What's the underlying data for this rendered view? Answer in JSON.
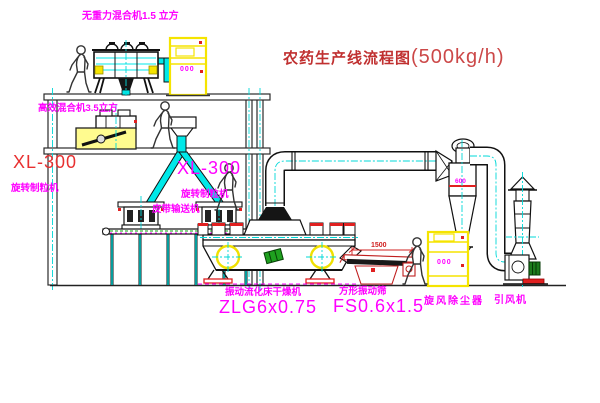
{
  "diagram": {
    "title_cn": "农药生产线流程图",
    "title_capacity": "(500kg/h)",
    "equipment_labels": {
      "gravity_free_mixer": "无重力混合机1.5 立方",
      "high_efficiency_mixer": "高效混合机3.5立方",
      "granulator_left_model": "XL-300",
      "granulator_left_name": "旋转制粒机",
      "granulator_right_model": "XL-300",
      "granulator_right_name": "旋转制粒机",
      "belt_conveyor": "皮带输送机",
      "dryer_name": "振动流化床干燥机",
      "dryer_model": "ZLG6x0.75",
      "sieve_name": "方形振动筛",
      "sieve_model": "FS0.6x1.5",
      "cyclone": "旋风除尘器",
      "induced_draft_fan": "引风机"
    },
    "dimensions": {
      "sieve_width": "1500",
      "cyclone_marking": "600"
    },
    "cabinet_indicator": "000",
    "colors": {
      "label_magenta": "#FF00FF",
      "annotation_red": "#E02020",
      "centerline_cyan": "#00D8D8",
      "cabinet_yellow": "#F5E400",
      "title_red": "#C03030"
    }
  }
}
